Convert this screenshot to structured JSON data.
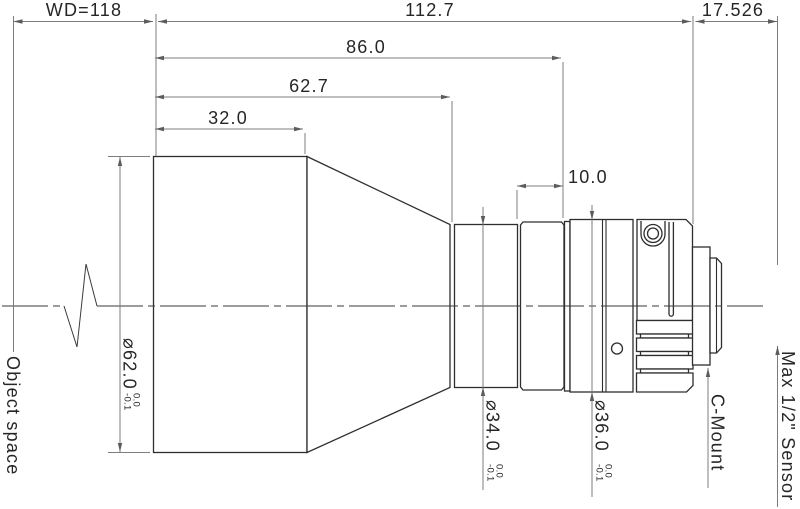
{
  "drawing": {
    "type": "lens-mechanical-drawing",
    "colors": {
      "background": "#ffffff",
      "outline": "#2e2e2e",
      "dimension_line": "#7d7d7d",
      "text": "#262626"
    },
    "dimensions": {
      "working_distance": "WD=118",
      "overall_length": "112.7",
      "flange_distance": "17.526",
      "length_86": "86.0",
      "length_62_7": "62.7",
      "length_32": "32.0",
      "length_10": "10.0"
    },
    "diameters": {
      "front": {
        "label": "⌀62.0",
        "tol_upper": "0.0",
        "tol_lower": "-0.1"
      },
      "mid": {
        "label": "⌀34.0",
        "tol_upper": "0.0",
        "tol_lower": "-0.1"
      },
      "rear": {
        "label": "⌀36.0",
        "tol_upper": "0.0",
        "tol_lower": "-0.1"
      }
    },
    "annotations": {
      "object_space": "Object space",
      "c_mount": "C-Mount",
      "max_sensor": "Max 1/2\" Sensor"
    }
  }
}
